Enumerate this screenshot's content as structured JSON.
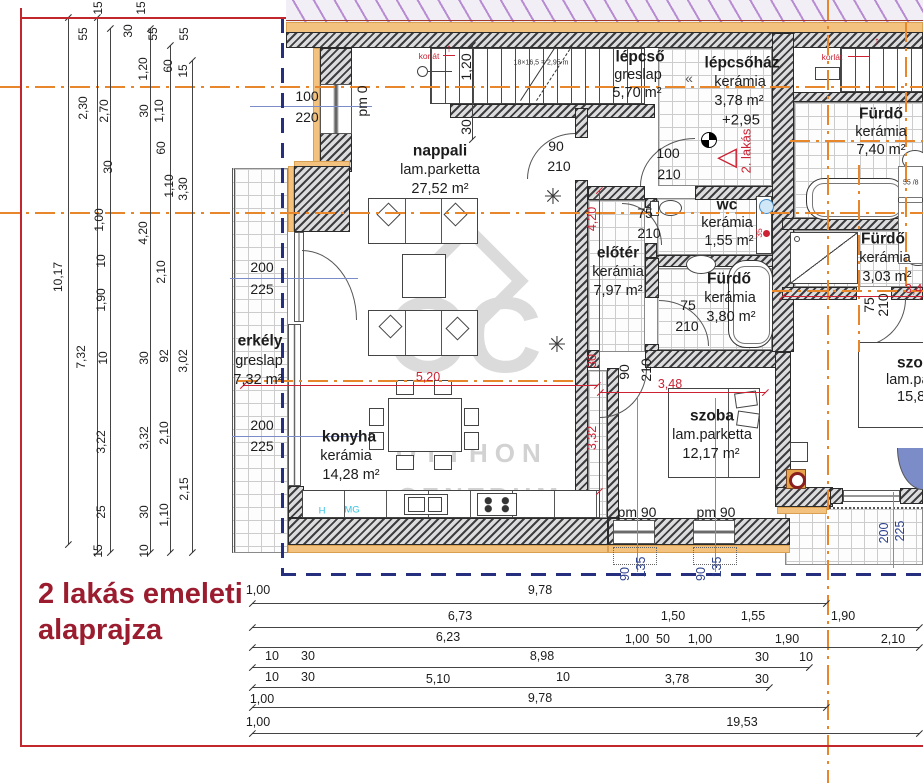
{
  "title": {
    "line1": "2 lakás emeleti",
    "line2": "alaprajza"
  },
  "watermark": {
    "monogram": "OC",
    "line1": "OTTHON",
    "line2": "CENTRUM"
  },
  "palette": {
    "wall": "#3e3e42",
    "insulation": "#f2c27e",
    "centerline_orange": "#e8862c",
    "boundary_navy": "#252f7d",
    "dim_red": "#cc2233",
    "title_red": "#9a1c2e",
    "window_blue": "#7b8cc8",
    "cyan": "#35c2e2"
  },
  "rooms": [
    {
      "name": "nappali",
      "floor": "lam.parketta",
      "area": "27,52 m²"
    },
    {
      "name": "lépcső",
      "floor": "greslap",
      "area": "5,70 m²"
    },
    {
      "name": "lépcsőház",
      "floor": "kerámia",
      "area": "3,78 m²"
    },
    {
      "name": "Fürdő",
      "floor": "kerámia",
      "area": "7,40 m²"
    },
    {
      "name": "wc",
      "floor": "kerámia",
      "area": "1,55 m²"
    },
    {
      "name": "előtér",
      "floor": "kerámia",
      "area": "7,97 m²"
    },
    {
      "name": "Fürdő",
      "floor": "kerámia",
      "area": "3,80 m²"
    },
    {
      "name": "Fürdő",
      "floor": "kerámia",
      "area": "3,03 m²"
    },
    {
      "name": "erkély",
      "floor": "greslap",
      "area": "7,32 m²"
    },
    {
      "name": "konyha",
      "floor": "kerámia",
      "area": "14,28 m²"
    },
    {
      "name": "szoba",
      "floor": "lam.parketta",
      "area": "12,17 m²"
    },
    {
      "name": "szo (clipped)",
      "floor": "lam.pa (clipped)",
      "area": "15,8 (clipped)"
    }
  ],
  "labels": [
    {
      "t": "nappali",
      "x": 440,
      "y": 151,
      "c": "rmb",
      "n": "room-label-nappali"
    },
    {
      "t": "lam.parketta",
      "x": 440,
      "y": 170,
      "c": "rm"
    },
    {
      "t": "27,52 m²",
      "x": 440,
      "y": 189,
      "c": "rm"
    },
    {
      "t": "lépcső",
      "x": 640,
      "y": 57,
      "c": "rmb",
      "n": "room-label-lepcso"
    },
    {
      "t": "greslap",
      "x": 638,
      "y": 75,
      "c": "rm"
    },
    {
      "t": "5,70 m²",
      "x": 637,
      "y": 93,
      "c": "rm"
    },
    {
      "t": "lépcsőház",
      "x": 742,
      "y": 63,
      "c": "rmb",
      "n": "room-label-lepcsohaz"
    },
    {
      "t": "kerámia",
      "x": 740,
      "y": 82,
      "c": "rm"
    },
    {
      "t": "3,78 m²",
      "x": 739,
      "y": 101,
      "c": "rm"
    },
    {
      "t": "Fürdő",
      "x": 881,
      "y": 114,
      "c": "rmb",
      "n": "room-label-furdo-1"
    },
    {
      "t": "kerámia",
      "x": 881,
      "y": 132,
      "c": "rm"
    },
    {
      "t": "7,40 m²",
      "x": 881,
      "y": 150,
      "c": "rm"
    },
    {
      "t": "wc",
      "x": 727,
      "y": 205,
      "c": "rmb",
      "n": "room-label-wc"
    },
    {
      "t": "kerámia",
      "x": 727,
      "y": 223,
      "c": "rm"
    },
    {
      "t": "1,55 m²",
      "x": 729,
      "y": 241,
      "c": "rm"
    },
    {
      "t": "előtér",
      "x": 618,
      "y": 253,
      "c": "rmb",
      "n": "room-label-eloter"
    },
    {
      "t": "kerámia",
      "x": 618,
      "y": 272,
      "c": "rm"
    },
    {
      "t": "7,97 m²",
      "x": 618,
      "y": 291,
      "c": "rm"
    },
    {
      "t": "Fürdő",
      "x": 729,
      "y": 279,
      "c": "rmb",
      "n": "room-label-furdo-2"
    },
    {
      "t": "kerámia",
      "x": 730,
      "y": 298,
      "c": "rm"
    },
    {
      "t": "3,80 m²",
      "x": 731,
      "y": 317,
      "c": "rm"
    },
    {
      "t": "Fürdő",
      "x": 883,
      "y": 239,
      "c": "rmb",
      "n": "room-label-furdo-3"
    },
    {
      "t": "kerámia",
      "x": 885,
      "y": 258,
      "c": "rm"
    },
    {
      "t": "3,03 m²",
      "x": 887,
      "y": 277,
      "c": "rm"
    },
    {
      "t": "erkély",
      "x": 260,
      "y": 341,
      "c": "rmb",
      "n": "room-label-erkely"
    },
    {
      "t": "greslap",
      "x": 259,
      "y": 361,
      "c": "rm"
    },
    {
      "t": "7,32 m²",
      "x": 258,
      "y": 380,
      "c": "rm"
    },
    {
      "t": "konyha",
      "x": 349,
      "y": 437,
      "c": "rmb",
      "n": "room-label-konyha"
    },
    {
      "t": "kerámia",
      "x": 346,
      "y": 456,
      "c": "rm"
    },
    {
      "t": "14,28 m²",
      "x": 351,
      "y": 475,
      "c": "rm"
    },
    {
      "t": "szoba",
      "x": 712,
      "y": 416,
      "c": "rmb",
      "n": "room-label-szoba"
    },
    {
      "t": "lam.parketta",
      "x": 712,
      "y": 435,
      "c": "rm"
    },
    {
      "t": "12,17 m²",
      "x": 711,
      "y": 454,
      "c": "rm"
    },
    {
      "t": "szo",
      "x": 897,
      "y": 363,
      "c": "rmb la",
      "n": "room-label-szoba-2"
    },
    {
      "t": "lam.pa",
      "x": 886,
      "y": 380,
      "c": "rm la"
    },
    {
      "t": "15,8",
      "x": 897,
      "y": 397,
      "c": "rm la"
    },
    {
      "t": "100",
      "x": 307,
      "y": 96,
      "c": "w"
    },
    {
      "t": "220",
      "x": 307,
      "y": 117,
      "c": "w"
    },
    {
      "t": "200",
      "x": 262,
      "y": 267,
      "c": "w"
    },
    {
      "t": "225",
      "x": 262,
      "y": 289,
      "c": "w"
    },
    {
      "t": "200",
      "x": 262,
      "y": 425,
      "c": "w"
    },
    {
      "t": "225",
      "x": 262,
      "y": 446,
      "c": "w"
    },
    {
      "t": "90",
      "x": 556,
      "y": 146,
      "c": "w"
    },
    {
      "t": "210",
      "x": 559,
      "y": 166,
      "c": "w"
    },
    {
      "t": "100",
      "x": 668,
      "y": 153,
      "c": "w"
    },
    {
      "t": "210",
      "x": 669,
      "y": 174,
      "c": "w"
    },
    {
      "t": "75",
      "x": 645,
      "y": 213,
      "c": "w"
    },
    {
      "t": "210",
      "x": 649,
      "y": 233,
      "c": "w"
    },
    {
      "t": "75",
      "x": 688,
      "y": 305,
      "c": "w"
    },
    {
      "t": "210",
      "x": 687,
      "y": 326,
      "c": "w"
    },
    {
      "t": "pm 90",
      "x": 637,
      "y": 512,
      "c": "w"
    },
    {
      "t": "pm 90",
      "x": 716,
      "y": 512,
      "c": "w"
    },
    {
      "t": "pm 0",
      "x": 362,
      "y": 101,
      "c": "wr"
    },
    {
      "t": "1,20",
      "x": 466,
      "y": 67,
      "c": "wr"
    },
    {
      "t": "30",
      "x": 466,
      "y": 127,
      "c": "wr"
    },
    {
      "t": "90",
      "x": 624,
      "y": 372,
      "c": "wr"
    },
    {
      "t": "210",
      "x": 646,
      "y": 370,
      "c": "wr"
    },
    {
      "t": "75",
      "x": 869,
      "y": 305,
      "c": "wr"
    },
    {
      "t": "210",
      "x": 883,
      "y": 305,
      "c": "wr"
    },
    {
      "t": "90",
      "x": 625,
      "y": 574,
      "c": "nr"
    },
    {
      "t": "135",
      "x": 641,
      "y": 567,
      "c": "nr"
    },
    {
      "t": "90",
      "x": 701,
      "y": 574,
      "c": "nr"
    },
    {
      "t": "135",
      "x": 717,
      "y": 567,
      "c": "nr"
    },
    {
      "t": "200",
      "x": 884,
      "y": 533,
      "c": "nr"
    },
    {
      "t": "225",
      "x": 900,
      "y": 531,
      "c": "nr"
    },
    {
      "t": "5,20",
      "x": 428,
      "y": 377,
      "c": "r"
    },
    {
      "t": "3,48",
      "x": 670,
      "y": 384,
      "c": "r"
    },
    {
      "t": "3,4",
      "x": 905,
      "y": 289,
      "c": "r la"
    },
    {
      "t": "4,20",
      "x": 592,
      "y": 219,
      "c": "rr"
    },
    {
      "t": "30",
      "x": 592,
      "y": 361,
      "c": "rr"
    },
    {
      "t": "3,32",
      "x": 592,
      "y": 438,
      "c": "rr"
    },
    {
      "t": "2. lakás",
      "x": 746,
      "y": 151,
      "c": "rr2",
      "n": "apartment-2-marker"
    },
    {
      "t": "korlát",
      "x": 429,
      "y": 56,
      "c": "rt",
      "n": "railing-note"
    },
    {
      "t": "korlát",
      "x": 832,
      "y": 57,
      "c": "rt",
      "n": "railing-note"
    },
    {
      "t": "↑",
      "x": 449,
      "y": 49,
      "c": "ra",
      "n": "arrow-up-icon"
    },
    {
      "t": "↑",
      "x": 877,
      "y": 42,
      "c": "ra",
      "n": "arrow-up-icon"
    },
    {
      "t": "35",
      "x": 759,
      "y": 233,
      "c": "rtr"
    },
    {
      "t": "+2,95",
      "x": 741,
      "y": 120,
      "c": "an",
      "n": "level-marker-value"
    },
    {
      "t": "18×16,5 = 2,95 m",
      "x": 541,
      "y": 63,
      "c": "tn",
      "n": "stair-note"
    },
    {
      "t": "55 /8",
      "x": 903,
      "y": 183,
      "c": "tn la",
      "n": "washer-size-note"
    },
    {
      "t": "H",
      "x": 322,
      "y": 511,
      "c": "cy",
      "n": "fridge-mark"
    },
    {
      "t": "MG",
      "x": 352,
      "y": 510,
      "c": "cy",
      "n": "dishwasher-mark"
    },
    {
      "t": "✳",
      "x": 553,
      "y": 197,
      "c": "pl",
      "n": "plant-icon"
    },
    {
      "t": "✳",
      "x": 557,
      "y": 345,
      "c": "pl",
      "n": "plant-icon"
    },
    {
      "t": "◁",
      "x": 727,
      "y": 156,
      "c": "tri",
      "n": "entrance-marker-icon"
    },
    {
      "t": "«",
      "x": 689,
      "y": 78,
      "c": "chev",
      "n": "stair-direction-icon"
    },
    {
      "t": "15",
      "x": 98,
      "y": 8,
      "c": "d"
    },
    {
      "t": "55",
      "x": 83,
      "y": 34,
      "c": "d"
    },
    {
      "t": "30",
      "x": 128,
      "y": 31,
      "c": "d"
    },
    {
      "t": "15",
      "x": 141,
      "y": 8,
      "c": "d"
    },
    {
      "t": "55",
      "x": 153,
      "y": 34,
      "c": "d"
    },
    {
      "t": "55",
      "x": 184,
      "y": 34,
      "c": "d"
    },
    {
      "t": "1,20",
      "x": 143,
      "y": 69,
      "c": "d"
    },
    {
      "t": "60",
      "x": 168,
      "y": 66,
      "c": "d"
    },
    {
      "t": "15",
      "x": 183,
      "y": 71,
      "c": "d"
    },
    {
      "t": "2,30",
      "x": 83,
      "y": 108,
      "c": "d"
    },
    {
      "t": "2,70",
      "x": 104,
      "y": 111,
      "c": "d"
    },
    {
      "t": "30",
      "x": 144,
      "y": 111,
      "c": "d"
    },
    {
      "t": "1,10",
      "x": 159,
      "y": 111,
      "c": "d"
    },
    {
      "t": "30",
      "x": 108,
      "y": 167,
      "c": "d"
    },
    {
      "t": "60",
      "x": 161,
      "y": 148,
      "c": "d"
    },
    {
      "t": "1,10",
      "x": 169,
      "y": 186,
      "c": "d"
    },
    {
      "t": "3,30",
      "x": 183,
      "y": 189,
      "c": "d"
    },
    {
      "t": "1,00",
      "x": 99,
      "y": 220,
      "c": "d"
    },
    {
      "t": "4,20",
      "x": 143,
      "y": 233,
      "c": "d"
    },
    {
      "t": "10",
      "x": 101,
      "y": 261,
      "c": "d"
    },
    {
      "t": "2,10",
      "x": 161,
      "y": 272,
      "c": "d"
    },
    {
      "t": "10,17",
      "x": 58,
      "y": 277,
      "c": "d"
    },
    {
      "t": "1,90",
      "x": 101,
      "y": 300,
      "c": "d"
    },
    {
      "t": "7,32",
      "x": 81,
      "y": 357,
      "c": "d"
    },
    {
      "t": "10",
      "x": 103,
      "y": 358,
      "c": "d"
    },
    {
      "t": "30",
      "x": 144,
      "y": 358,
      "c": "d"
    },
    {
      "t": "92",
      "x": 164,
      "y": 356,
      "c": "d"
    },
    {
      "t": "3,02",
      "x": 183,
      "y": 361,
      "c": "d"
    },
    {
      "t": "3,22",
      "x": 101,
      "y": 442,
      "c": "d"
    },
    {
      "t": "3,32",
      "x": 144,
      "y": 438,
      "c": "d"
    },
    {
      "t": "2,10",
      "x": 164,
      "y": 433,
      "c": "d"
    },
    {
      "t": "2,15",
      "x": 184,
      "y": 489,
      "c": "d"
    },
    {
      "t": "25",
      "x": 101,
      "y": 512,
      "c": "d"
    },
    {
      "t": "30",
      "x": 144,
      "y": 512,
      "c": "d"
    },
    {
      "t": "1,10",
      "x": 164,
      "y": 515,
      "c": "d"
    },
    {
      "t": "15",
      "x": 98,
      "y": 551,
      "c": "d"
    },
    {
      "t": "10",
      "x": 144,
      "y": 551,
      "c": "d"
    },
    {
      "t": "1,00",
      "x": 258,
      "y": 590,
      "c": "dh"
    },
    {
      "t": "9,78",
      "x": 540,
      "y": 590,
      "c": "dh"
    },
    {
      "t": "6,73",
      "x": 460,
      "y": 616,
      "c": "dh"
    },
    {
      "t": "1,50",
      "x": 673,
      "y": 616,
      "c": "dh"
    },
    {
      "t": "1,55",
      "x": 753,
      "y": 616,
      "c": "dh"
    },
    {
      "t": "1,90",
      "x": 843,
      "y": 616,
      "c": "dh"
    },
    {
      "t": "6,23",
      "x": 448,
      "y": 637,
      "c": "dh"
    },
    {
      "t": "1,00",
      "x": 637,
      "y": 639,
      "c": "dh"
    },
    {
      "t": "50",
      "x": 663,
      "y": 639,
      "c": "dh"
    },
    {
      "t": "1,00",
      "x": 700,
      "y": 639,
      "c": "dh"
    },
    {
      "t": "1,90",
      "x": 787,
      "y": 639,
      "c": "dh"
    },
    {
      "t": "2,10",
      "x": 893,
      "y": 639,
      "c": "dh"
    },
    {
      "t": "10",
      "x": 272,
      "y": 656,
      "c": "dh"
    },
    {
      "t": "30",
      "x": 308,
      "y": 656,
      "c": "dh"
    },
    {
      "t": "8,98",
      "x": 542,
      "y": 656,
      "c": "dh"
    },
    {
      "t": "30",
      "x": 762,
      "y": 657,
      "c": "dh"
    },
    {
      "t": "10",
      "x": 806,
      "y": 657,
      "c": "dh"
    },
    {
      "t": "10",
      "x": 272,
      "y": 677,
      "c": "dh"
    },
    {
      "t": "30",
      "x": 308,
      "y": 677,
      "c": "dh"
    },
    {
      "t": "5,10",
      "x": 438,
      "y": 679,
      "c": "dh"
    },
    {
      "t": "10",
      "x": 563,
      "y": 677,
      "c": "dh"
    },
    {
      "t": "3,78",
      "x": 677,
      "y": 679,
      "c": "dh"
    },
    {
      "t": "30",
      "x": 762,
      "y": 679,
      "c": "dh"
    },
    {
      "t": "1,00",
      "x": 262,
      "y": 699,
      "c": "dh"
    },
    {
      "t": "9,78",
      "x": 540,
      "y": 698,
      "c": "dh"
    },
    {
      "t": "1,00",
      "x": 258,
      "y": 722,
      "c": "dh"
    },
    {
      "t": "19,53",
      "x": 742,
      "y": 722,
      "c": "dh"
    }
  ]
}
